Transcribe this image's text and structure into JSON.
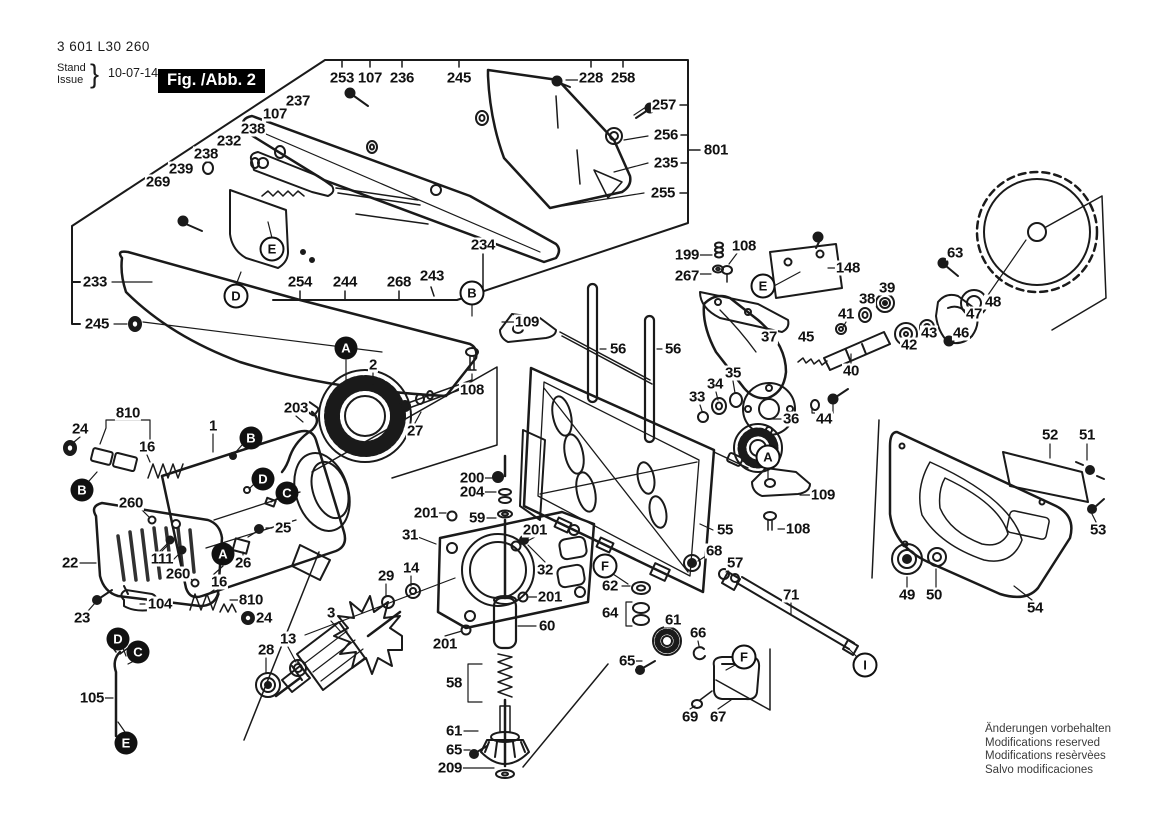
{
  "header": {
    "part_number": "3 601 L30 260",
    "stand_label": "Stand",
    "issue_label": "Issue",
    "brace": "}",
    "date": "10-07-14",
    "figure_label": "Fig. /Abb. 2"
  },
  "footer": {
    "notices": [
      "Änderungen vorbehalten",
      "Modifications reserved",
      "Modifications resèrvèes",
      "Salvo modificaciones"
    ]
  },
  "diagram": {
    "callouts": [
      {
        "text": "253",
        "x": 342,
        "y": 78
      },
      {
        "text": "107",
        "x": 370,
        "y": 78
      },
      {
        "text": "236",
        "x": 402,
        "y": 78
      },
      {
        "text": "245",
        "x": 459,
        "y": 78
      },
      {
        "text": "228",
        "x": 591,
        "y": 78
      },
      {
        "text": "258",
        "x": 623,
        "y": 78
      },
      {
        "text": "257",
        "x": 664,
        "y": 105
      },
      {
        "text": "256",
        "x": 666,
        "y": 135
      },
      {
        "text": "801",
        "x": 716,
        "y": 150
      },
      {
        "text": "235",
        "x": 666,
        "y": 163
      },
      {
        "text": "255",
        "x": 663,
        "y": 193
      },
      {
        "text": "237",
        "x": 298,
        "y": 101
      },
      {
        "text": "107",
        "x": 275,
        "y": 114
      },
      {
        "text": "238",
        "x": 253,
        "y": 129
      },
      {
        "text": "232",
        "x": 229,
        "y": 141
      },
      {
        "text": "238",
        "x": 206,
        "y": 154
      },
      {
        "text": "239",
        "x": 181,
        "y": 169
      },
      {
        "text": "269",
        "x": 158,
        "y": 182
      },
      {
        "text": "233",
        "x": 95,
        "y": 282
      },
      {
        "text": "245",
        "x": 97,
        "y": 324
      },
      {
        "text": "254",
        "x": 300,
        "y": 282
      },
      {
        "text": "244",
        "x": 345,
        "y": 282
      },
      {
        "text": "268",
        "x": 399,
        "y": 282
      },
      {
        "text": "243",
        "x": 432,
        "y": 276
      },
      {
        "text": "234",
        "x": 483,
        "y": 245
      },
      {
        "text": "199",
        "x": 687,
        "y": 255
      },
      {
        "text": "108",
        "x": 744,
        "y": 246
      },
      {
        "text": "267",
        "x": 687,
        "y": 276
      },
      {
        "text": "148",
        "x": 848,
        "y": 268
      },
      {
        "text": "63",
        "x": 955,
        "y": 253
      },
      {
        "text": "39",
        "x": 887,
        "y": 288
      },
      {
        "text": "38",
        "x": 867,
        "y": 299
      },
      {
        "text": "41",
        "x": 846,
        "y": 314
      },
      {
        "text": "37",
        "x": 769,
        "y": 337
      },
      {
        "text": "45",
        "x": 806,
        "y": 337
      },
      {
        "text": "40",
        "x": 851,
        "y": 371
      },
      {
        "text": "36",
        "x": 791,
        "y": 419
      },
      {
        "text": "44",
        "x": 824,
        "y": 419
      },
      {
        "text": "35",
        "x": 733,
        "y": 373
      },
      {
        "text": "34",
        "x": 715,
        "y": 384
      },
      {
        "text": "33",
        "x": 697,
        "y": 397
      },
      {
        "text": "42",
        "x": 909,
        "y": 345
      },
      {
        "text": "43",
        "x": 929,
        "y": 333
      },
      {
        "text": "46",
        "x": 961,
        "y": 333
      },
      {
        "text": "47",
        "x": 974,
        "y": 314
      },
      {
        "text": "48",
        "x": 993,
        "y": 302
      },
      {
        "text": "109",
        "x": 527,
        "y": 322
      },
      {
        "text": "108",
        "x": 472,
        "y": 390
      },
      {
        "text": "56",
        "x": 618,
        "y": 349
      },
      {
        "text": "56",
        "x": 673,
        "y": 349
      },
      {
        "text": "2",
        "x": 373,
        "y": 365
      },
      {
        "text": "203",
        "x": 296,
        "y": 408
      },
      {
        "text": "27",
        "x": 415,
        "y": 431
      },
      {
        "text": "810",
        "x": 128,
        "y": 413
      },
      {
        "text": "24",
        "x": 80,
        "y": 429
      },
      {
        "text": "16",
        "x": 147,
        "y": 447
      },
      {
        "text": "1",
        "x": 213,
        "y": 426
      },
      {
        "text": "260",
        "x": 131,
        "y": 503
      },
      {
        "text": "25",
        "x": 283,
        "y": 528
      },
      {
        "text": "26",
        "x": 243,
        "y": 563
      },
      {
        "text": "22",
        "x": 70,
        "y": 563
      },
      {
        "text": "111",
        "x": 162,
        "y": 559
      },
      {
        "text": "104",
        "x": 160,
        "y": 604
      },
      {
        "text": "23",
        "x": 82,
        "y": 618
      },
      {
        "text": "260",
        "x": 178,
        "y": 574
      },
      {
        "text": "16",
        "x": 219,
        "y": 582
      },
      {
        "text": "810",
        "x": 251,
        "y": 600
      },
      {
        "text": "24",
        "x": 264,
        "y": 618
      },
      {
        "text": "105",
        "x": 92,
        "y": 698
      },
      {
        "text": "28",
        "x": 266,
        "y": 650
      },
      {
        "text": "13",
        "x": 288,
        "y": 639
      },
      {
        "text": "3",
        "x": 331,
        "y": 613
      },
      {
        "text": "29",
        "x": 386,
        "y": 576
      },
      {
        "text": "14",
        "x": 411,
        "y": 568
      },
      {
        "text": "31",
        "x": 410,
        "y": 535
      },
      {
        "text": "200",
        "x": 472,
        "y": 478
      },
      {
        "text": "204",
        "x": 472,
        "y": 492
      },
      {
        "text": "201",
        "x": 426,
        "y": 513
      },
      {
        "text": "59",
        "x": 477,
        "y": 518
      },
      {
        "text": "201",
        "x": 535,
        "y": 530
      },
      {
        "text": "32",
        "x": 545,
        "y": 570
      },
      {
        "text": "201",
        "x": 550,
        "y": 597
      },
      {
        "text": "60",
        "x": 547,
        "y": 626
      },
      {
        "text": "201",
        "x": 445,
        "y": 644
      },
      {
        "text": "58",
        "x": 454,
        "y": 683
      },
      {
        "text": "61",
        "x": 454,
        "y": 731
      },
      {
        "text": "65",
        "x": 454,
        "y": 750
      },
      {
        "text": "209",
        "x": 450,
        "y": 768
      },
      {
        "text": "55",
        "x": 725,
        "y": 530
      },
      {
        "text": "68",
        "x": 714,
        "y": 551
      },
      {
        "text": "57",
        "x": 735,
        "y": 563
      },
      {
        "text": "62",
        "x": 610,
        "y": 586
      },
      {
        "text": "64",
        "x": 610,
        "y": 613
      },
      {
        "text": "71",
        "x": 791,
        "y": 595
      },
      {
        "text": "61",
        "x": 673,
        "y": 620
      },
      {
        "text": "66",
        "x": 698,
        "y": 633
      },
      {
        "text": "65",
        "x": 627,
        "y": 661
      },
      {
        "text": "69",
        "x": 690,
        "y": 717
      },
      {
        "text": "67",
        "x": 718,
        "y": 717
      },
      {
        "text": "109",
        "x": 823,
        "y": 495
      },
      {
        "text": "108",
        "x": 798,
        "y": 529
      },
      {
        "text": "52",
        "x": 1050,
        "y": 435
      },
      {
        "text": "51",
        "x": 1087,
        "y": 435
      },
      {
        "text": "53",
        "x": 1098,
        "y": 530
      },
      {
        "text": "49",
        "x": 907,
        "y": 595
      },
      {
        "text": "50",
        "x": 934,
        "y": 595
      },
      {
        "text": "54",
        "x": 1035,
        "y": 608
      }
    ],
    "letter_markers": [
      {
        "letter": "E",
        "x": 272,
        "y": 249,
        "style": "outline"
      },
      {
        "letter": "D",
        "x": 236,
        "y": 296,
        "style": "outline"
      },
      {
        "letter": "B",
        "x": 472,
        "y": 293,
        "style": "outline"
      },
      {
        "letter": "E",
        "x": 763,
        "y": 286,
        "style": "outline"
      },
      {
        "letter": "A",
        "x": 768,
        "y": 457,
        "style": "outline"
      },
      {
        "letter": "F",
        "x": 605,
        "y": 566,
        "style": "outline"
      },
      {
        "letter": "F",
        "x": 744,
        "y": 657,
        "style": "outline"
      },
      {
        "letter": "I",
        "x": 865,
        "y": 665,
        "style": "outline"
      },
      {
        "letter": "A",
        "x": 346,
        "y": 348,
        "style": "filled"
      },
      {
        "letter": "B",
        "x": 251,
        "y": 438,
        "style": "filled"
      },
      {
        "letter": "D",
        "x": 263,
        "y": 479,
        "style": "filled"
      },
      {
        "letter": "C",
        "x": 287,
        "y": 493,
        "style": "filled"
      },
      {
        "letter": "B",
        "x": 82,
        "y": 490,
        "style": "filled"
      },
      {
        "letter": "A",
        "x": 223,
        "y": 554,
        "style": "filled"
      },
      {
        "letter": "D",
        "x": 118,
        "y": 639,
        "style": "filled"
      },
      {
        "letter": "C",
        "x": 138,
        "y": 652,
        "style": "filled"
      },
      {
        "letter": "E",
        "x": 126,
        "y": 743,
        "style": "filled"
      }
    ]
  }
}
